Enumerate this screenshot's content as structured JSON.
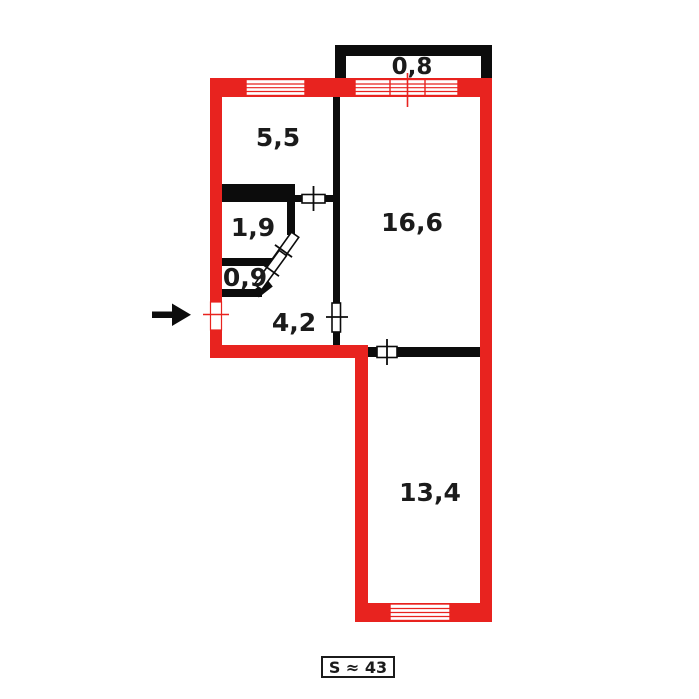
{
  "plan": {
    "type": "apartment-floor-plan",
    "rooms": [
      {
        "id": "balcony",
        "area_label": "0,8"
      },
      {
        "id": "room-top",
        "area_label": "5,5"
      },
      {
        "id": "closet-big",
        "area_label": "1,9"
      },
      {
        "id": "closet-small",
        "area_label": "0,9"
      },
      {
        "id": "hallway",
        "area_label": "4,2"
      },
      {
        "id": "living-room",
        "area_label": "16,6"
      },
      {
        "id": "bedroom",
        "area_label": "13,4"
      }
    ],
    "total_area_label": "S ≈ 43",
    "colors": {
      "outer_wall": "#e8231f",
      "inner_wall": "#0c0c0c",
      "background": "#ffffff",
      "text": "#1b1b1b"
    }
  }
}
